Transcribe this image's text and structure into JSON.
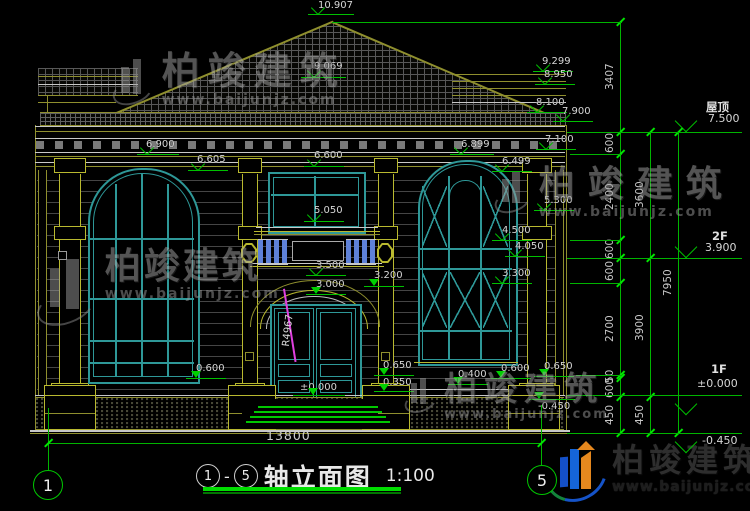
{
  "drawing": {
    "title": {
      "axis_start": "1",
      "sep": "-",
      "axis_end": "5",
      "text": "轴立面图",
      "scale": "1:100"
    },
    "overall_width_dim": "13800",
    "axis_bubbles": [
      {
        "label": "1",
        "x": 47,
        "y": 484
      },
      {
        "label": "5",
        "x": 541,
        "y": 479
      }
    ],
    "annotations": {
      "radius_label": "R4967"
    },
    "colors": {
      "dim_green": "#00c000",
      "teal": "#2e9898",
      "olive": "#8f8f2e",
      "yellow": "#b9b92f",
      "magenta": "#e040e0",
      "baluster_blue": "#5f82d8"
    },
    "levels": [
      {
        "v": "10.907",
        "tx": 318,
        "ty": 1,
        "lx": 308,
        "lw": 46,
        "ly": 14,
        "tri": 313
      },
      {
        "v": "9.069",
        "tx": 314,
        "ty": 62,
        "lx": 301,
        "lw": 45,
        "ly": 77,
        "tri": 309
      },
      {
        "v": "9.299",
        "tx": 542,
        "ty": 57,
        "lx": 533,
        "lw": 40,
        "ly": 71,
        "tri": 538
      },
      {
        "v": "8.950",
        "tx": 544,
        "ty": 70,
        "lx": 535,
        "lw": 40,
        "ly": 84,
        "tri": 540
      },
      {
        "v": "8.100",
        "tx": 536,
        "ty": 98,
        "lx": 527,
        "lw": 40,
        "ly": 112,
        "tri": 532
      },
      {
        "v": "7.900",
        "tx": 562,
        "ty": 107,
        "lx": 553,
        "lw": 40,
        "ly": 121,
        "tri": 558
      },
      {
        "v": "7.100",
        "tx": 545,
        "ty": 135,
        "lx": 536,
        "lw": 40,
        "ly": 149,
        "tri": 541
      },
      {
        "v": "6.900",
        "tx": 146,
        "ty": 140,
        "lx": 137,
        "lw": 42,
        "ly": 154,
        "tri": 142
      },
      {
        "v": "6.605",
        "tx": 197,
        "ty": 155,
        "lx": 188,
        "lw": 40,
        "ly": 170,
        "tri": 193
      },
      {
        "v": "6.600",
        "tx": 314,
        "ty": 151,
        "lx": 304,
        "lw": 40,
        "ly": 166,
        "tri": 309
      },
      {
        "v": "6.899",
        "tx": 461,
        "ty": 140,
        "lx": 450,
        "lw": 44,
        "ly": 154,
        "tri": 456
      },
      {
        "v": "6.499",
        "tx": 502,
        "ty": 157,
        "lx": 492,
        "lw": 40,
        "ly": 171,
        "tri": 497
      },
      {
        "v": "5.300",
        "tx": 544,
        "ty": 196,
        "lx": 534,
        "lw": 40,
        "ly": 210,
        "tri": 539
      },
      {
        "v": "5.050",
        "tx": 314,
        "ty": 206,
        "lx": 304,
        "lw": 40,
        "ly": 221,
        "tri": 309
      },
      {
        "v": "4.500",
        "tx": 502,
        "ty": 226,
        "lx": 492,
        "lw": 40,
        "ly": 240,
        "tri": 497
      },
      {
        "v": "4.050",
        "tx": 515,
        "ty": 242,
        "lx": 505,
        "lw": 40,
        "ly": 256,
        "tri": 510
      },
      {
        "v": "3.500",
        "tx": 316,
        "ty": 261,
        "lx": 306,
        "lw": 40,
        "ly": 275,
        "tri": 311
      },
      {
        "v": "3.300",
        "tx": 502,
        "ty": 269,
        "lx": 492,
        "lw": 40,
        "ly": 283,
        "tri": 497
      },
      {
        "v": "3.200",
        "tx": 374,
        "ty": 271,
        "lx": 364,
        "lw": 40,
        "ly": 286,
        "tri": 369,
        "filled": true
      },
      {
        "v": "3.000",
        "tx": 316,
        "ty": 280,
        "lx": 306,
        "lw": 40,
        "ly": 294,
        "tri": 311,
        "filled": true
      },
      {
        "v": "0.600",
        "tx": 196,
        "ty": 364,
        "lx": 186,
        "lw": 40,
        "ly": 378,
        "tri": 191,
        "filled": true
      },
      {
        "v": "0.650",
        "tx": 383,
        "ty": 361,
        "lx": 374,
        "lw": 40,
        "ly": 375,
        "tri": 379,
        "filled": true
      },
      {
        "v": "0.350",
        "tx": 383,
        "ty": 378,
        "lx": 374,
        "lw": 40,
        "ly": 391,
        "tri": 379,
        "filled": true
      },
      {
        "v": "0.400",
        "tx": 458,
        "ty": 370,
        "lx": 448,
        "lw": 40,
        "ly": 384,
        "tri": 453,
        "filled": true
      },
      {
        "v": "0.600",
        "tx": 501,
        "ty": 364,
        "lx": 491,
        "lw": 40,
        "ly": 378,
        "tri": 496,
        "filled": true
      },
      {
        "v": "0.650",
        "tx": 544,
        "ty": 362,
        "lx": 534,
        "lw": 40,
        "ly": 376,
        "tri": 539,
        "filled": true
      },
      {
        "v": "±0.000",
        "tx": 300,
        "ty": 383,
        "lx": 293,
        "lw": 52,
        "ly": 395,
        "tri": 308,
        "filled": true
      },
      {
        "v": "-0.450",
        "tx": 538,
        "ty": 402,
        "lx": 529,
        "lw": 46,
        "ly": 399,
        "tri": 534,
        "filled": true
      }
    ],
    "right_levels": [
      {
        "name": "屋顶",
        "value": "7.500",
        "nx": 706,
        "ny": 99,
        "vx": 708,
        "vy": 114,
        "ly": 132
      },
      {
        "name": "2F",
        "value": "3.900",
        "nx": 712,
        "ny": 229,
        "vx": 705,
        "vy": 243,
        "ly": 258
      },
      {
        "name": "1F",
        "value": "±0.000",
        "nx": 711,
        "ny": 362,
        "vx": 697,
        "vy": 379,
        "ly": 395,
        "triBelow": true
      },
      {
        "name": "",
        "value": "-0.450",
        "vx": 702,
        "vy": 436,
        "ly": 433,
        "triBelow": true
      }
    ],
    "dim_chains": [
      {
        "x": 620,
        "segments": [
          {
            "label": "3407",
            "y1": 22,
            "y2": 132
          },
          {
            "label": "600",
            "y1": 132,
            "y2": 154
          },
          {
            "label": "2400",
            "y1": 154,
            "y2": 240
          },
          {
            "label": "600",
            "y1": 240,
            "y2": 258
          },
          {
            "label": "600",
            "y1": 258,
            "y2": 283
          },
          {
            "label": "2700",
            "y1": 283,
            "y2": 375
          },
          {
            "label": "50",
            "y1": 375,
            "y2": 378
          },
          {
            "label": "600",
            "y1": 378,
            "y2": 397
          },
          {
            "label": "450",
            "y1": 397,
            "y2": 433
          }
        ]
      },
      {
        "x": 650,
        "segments": [
          {
            "label": "3600",
            "y1": 132,
            "y2": 258
          },
          {
            "label": "3900",
            "y1": 258,
            "y2": 397
          },
          {
            "label": "450",
            "y1": 397,
            "y2": 433
          }
        ]
      },
      {
        "x": 678,
        "segments": [
          {
            "label": "7950",
            "y1": 132,
            "y2": 433
          }
        ]
      }
    ],
    "green_lines": [
      {
        "x": 332,
        "y": 22,
        "w": 290,
        "h": 1
      },
      {
        "x": 567,
        "y": 132,
        "w": 175,
        "h": 1
      },
      {
        "x": 570,
        "y": 154,
        "w": 52,
        "h": 1
      },
      {
        "x": 570,
        "y": 240,
        "w": 52,
        "h": 1
      },
      {
        "x": 567,
        "y": 258,
        "w": 175,
        "h": 1
      },
      {
        "x": 570,
        "y": 283,
        "w": 52,
        "h": 1
      },
      {
        "x": 576,
        "y": 375,
        "w": 46,
        "h": 1
      },
      {
        "x": 567,
        "y": 395,
        "w": 175,
        "h": 1
      },
      {
        "x": 567,
        "y": 433,
        "w": 175,
        "h": 1
      },
      {
        "x": 48,
        "y": 443,
        "w": 493,
        "h": 1
      },
      {
        "x": 48,
        "y": 408,
        "w": 1.2,
        "h": 62
      },
      {
        "x": 541,
        "y": 405,
        "w": 1.2,
        "h": 60
      }
    ],
    "extra_ticks": [
      [
        48,
        443
      ],
      [
        541,
        443
      ]
    ],
    "watermark": {
      "brand": "柏竣建筑",
      "site": "www.baijunjz.com"
    },
    "watermarks_layout": [
      {
        "x": 112,
        "y": 52,
        "s": 38,
        "g": 52,
        "ls": 8
      },
      {
        "x": 36,
        "y": 248,
        "s": 36,
        "g": 76,
        "ls": 3
      },
      {
        "x": 494,
        "y": 166,
        "s": 36,
        "g": 46,
        "ls": 13
      },
      {
        "x": 404,
        "y": 372,
        "s": 33,
        "g": 40,
        "ls": 7
      }
    ],
    "logo": {
      "brand": "柏竣建筑",
      "site": "www.baijunjz.com"
    }
  }
}
